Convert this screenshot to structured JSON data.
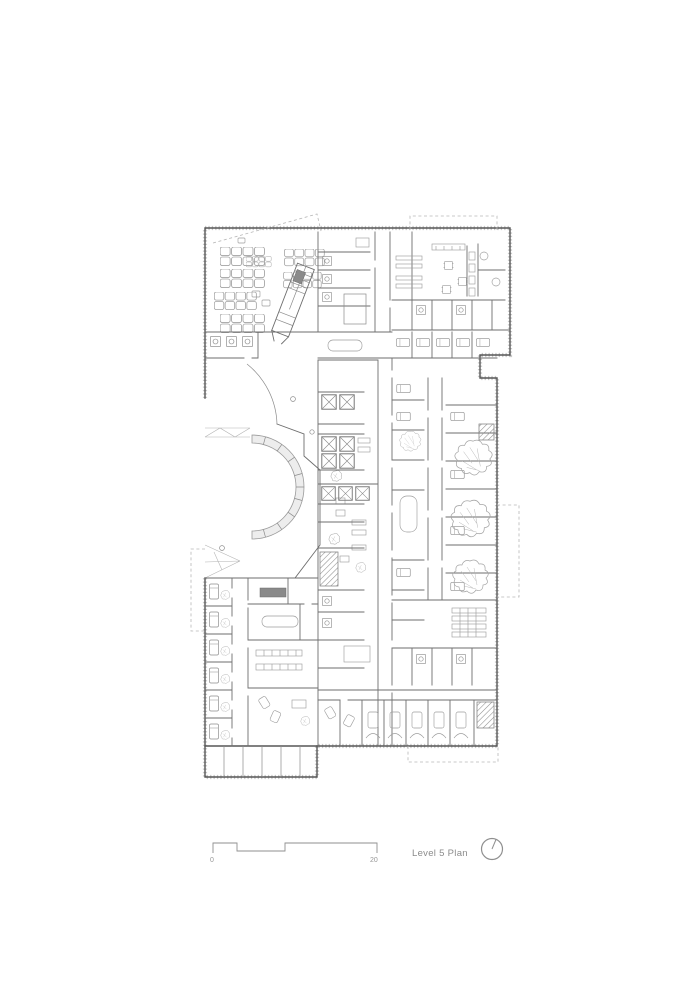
{
  "drawing": {
    "title": "Level 5 Plan",
    "scale_bar": {
      "start_label": "0",
      "end_label": "20"
    },
    "north_arrow_icon": "north-arrow-icon",
    "colors": {
      "paper": "#ffffff",
      "ink": "#565656",
      "light_ink": "#9e9e9e",
      "faint": "#c9c9c9",
      "annotation_text": "#8b8b8b"
    }
  }
}
